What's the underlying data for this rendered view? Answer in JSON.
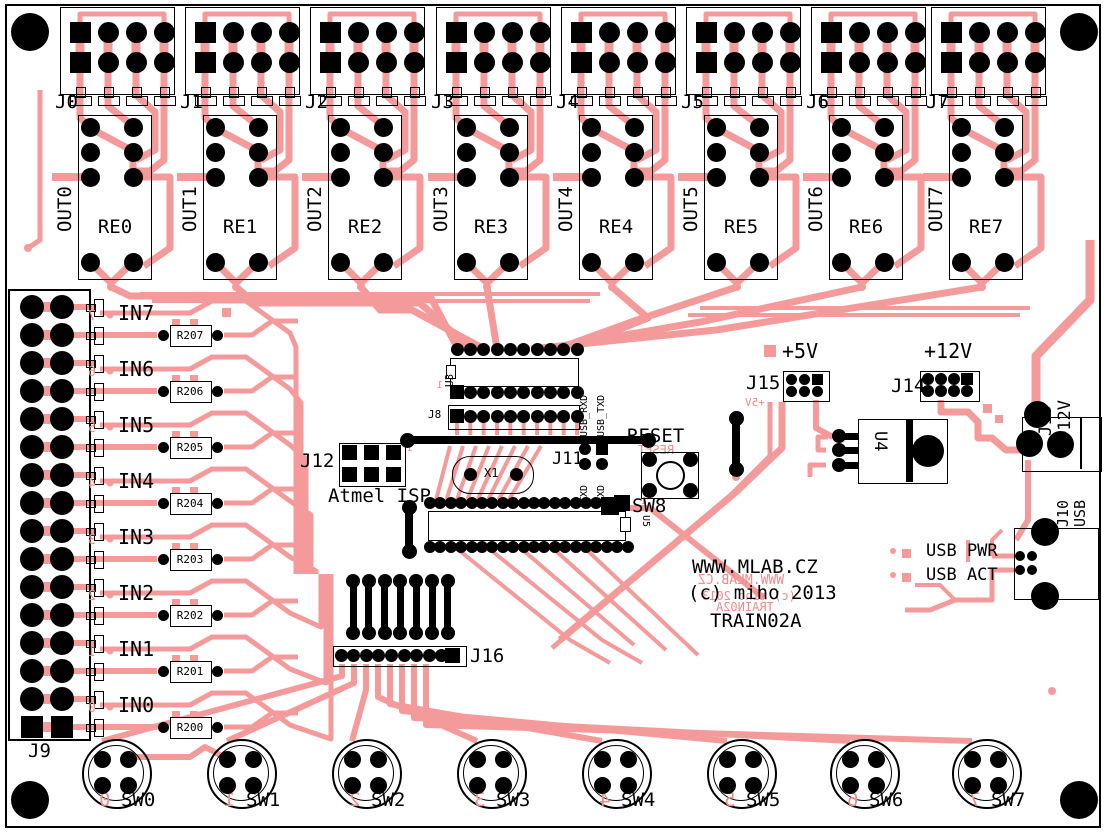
{
  "branding": {
    "website": "WWW.MLAB.CZ",
    "copyright": "(c) miho 2013",
    "title": "TRAIN02A"
  },
  "colors": {
    "board": "#ffffff",
    "trace": "#f49a9a",
    "silk_top": "#000000",
    "silk_bottom": "#f28b8b",
    "pad": "#000000"
  },
  "top_connectors": [
    {
      "connector": "J0",
      "output": "OUT0",
      "relay": "RE0"
    },
    {
      "connector": "J1",
      "output": "OUT1",
      "relay": "RE1"
    },
    {
      "connector": "J2",
      "output": "OUT2",
      "relay": "RE2"
    },
    {
      "connector": "J3",
      "output": "OUT3",
      "relay": "RE3"
    },
    {
      "connector": "J4",
      "output": "OUT4",
      "relay": "RE4"
    },
    {
      "connector": "J5",
      "output": "OUT5",
      "relay": "RE5"
    },
    {
      "connector": "J6",
      "output": "OUT6",
      "relay": "RE6"
    },
    {
      "connector": "J7",
      "output": "OUT7",
      "relay": "RE7"
    }
  ],
  "input_header": {
    "label": "J9",
    "channels": [
      {
        "input": "IN7",
        "resistor": "R207",
        "channel": "7"
      },
      {
        "input": "IN6",
        "resistor": "R206",
        "channel": "6"
      },
      {
        "input": "IN5",
        "resistor": "R205",
        "channel": "5"
      },
      {
        "input": "IN4",
        "resistor": "R204",
        "channel": "4"
      },
      {
        "input": "IN3",
        "resistor": "R203",
        "channel": "3"
      },
      {
        "input": "IN2",
        "resistor": "R202",
        "channel": "2"
      },
      {
        "input": "IN1",
        "resistor": "R201",
        "channel": "1"
      },
      {
        "input": "IN0",
        "resistor": "R200",
        "channel": "0"
      }
    ]
  },
  "switches": [
    {
      "label": "SW0",
      "channel": "0"
    },
    {
      "label": "SW1",
      "channel": "1"
    },
    {
      "label": "SW2",
      "channel": "2"
    },
    {
      "label": "SW3",
      "channel": "3"
    },
    {
      "label": "SW4",
      "channel": "4"
    },
    {
      "label": "SW5",
      "channel": "5"
    },
    {
      "label": "SW6",
      "channel": "6"
    },
    {
      "label": "SW7",
      "channel": "7"
    }
  ],
  "center": {
    "u3": "U3",
    "j8": "J8",
    "pin1": "1",
    "isp": {
      "label": "J12",
      "caption": "Atmel ISP",
      "pin1": "1"
    },
    "crystal": "X1",
    "serial": {
      "label": "J11",
      "top_labels": [
        "USB_RXD",
        "USB_TXD"
      ],
      "bottom_labels": [
        "TXD",
        "RXD"
      ]
    },
    "reset": {
      "label": "RESET",
      "mirror": "RESET",
      "pin1": "1"
    },
    "sw8": "SW8",
    "u5": "U5",
    "j16": "J16"
  },
  "power": {
    "v5": {
      "label": "+5V",
      "header": "J15",
      "mirror": "+5V"
    },
    "v12": {
      "label": "+12V",
      "header": "J14"
    },
    "regulator": "U4",
    "dc_jack": {
      "label": "J13",
      "voltage": "+12V"
    }
  },
  "usb": {
    "header": "J10",
    "type": "USB",
    "pwr_led": "USB PWR",
    "act_led": "USB ACT"
  }
}
